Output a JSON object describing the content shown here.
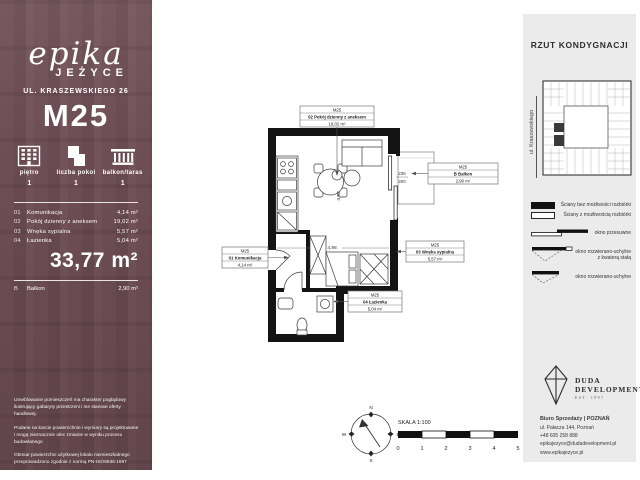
{
  "colors": {
    "maroon": "#6f4f56",
    "panel_gray": "#ebebeb",
    "wall_black": "#141414"
  },
  "left": {
    "logo_script": "epika",
    "logo_sub": "JEŻYCE",
    "address": "UL. KRASZEWSKIEGO 26",
    "unit": "M25",
    "stats": [
      {
        "icon": "building-floor-icon",
        "label": "piętro",
        "value": "1"
      },
      {
        "icon": "rooms-icon",
        "label": "liczba pokoi",
        "value": "1"
      },
      {
        "icon": "balcony-icon",
        "label": "balkon/taras",
        "value": "1"
      }
    ],
    "rooms": [
      {
        "no": "01",
        "name": "Komunikacja",
        "area": "4,14 m²"
      },
      {
        "no": "02",
        "name": "Pokój dzienny z aneksem",
        "area": "19,02 m²"
      },
      {
        "no": "03",
        "name": "Wnęka sypialna",
        "area": "5,57 m²"
      },
      {
        "no": "04",
        "name": "Łazienka",
        "area": "5,04 m²"
      }
    ],
    "total_area": "33,77 m²",
    "balcony_row": {
      "no": "B",
      "name": "Balkon",
      "area": "2,90 m²"
    },
    "disclaimers": [
      "Umeblowanie pomieszczeń ma charakter poglądowy ilustrujący gabaryty przestrzeni i nie stanowi oferty handlowej.",
      "Podane na karcie powierzchnie i wymiary są projektowane i mogą nieznacznie ulec zmianie w wyniku procesu budowlanego",
      "Obmiar powierzchni użytkowej lokalu niemieszkalnego przeprowadzono zgodnie z normą PN-ISO9836:1997"
    ]
  },
  "plan": {
    "labels": [
      {
        "unit": "M25",
        "room": "02 Pokój dzienny z aneksem",
        "area": "19,02 m²"
      },
      {
        "unit": "M25",
        "room": "B Balkon",
        "area": "2,90 m²"
      },
      {
        "unit": "M25",
        "room": "01 Komunikacja",
        "area": "4,14 m²"
      },
      {
        "unit": "M25",
        "room": "03 Wnęka sypialna",
        "area": "5,57 m²"
      },
      {
        "unit": "M25",
        "room": "04 Łazienka",
        "area": "5,04 m²"
      }
    ],
    "dims": {
      "living_width": "4,98",
      "living_depth": "3,92",
      "window_width": "235",
      "window_height": "200"
    },
    "scale": {
      "label": "SKALA 1:100",
      "ticks": [
        "0",
        "1",
        "2",
        "3",
        "4",
        "5"
      ]
    },
    "compass": {
      "n": "N",
      "e": "E",
      "s": "S",
      "w": "W"
    }
  },
  "right": {
    "title": "RZUT KONDYGNACJI",
    "street": "ul. Kraszewskiego",
    "legend": [
      {
        "label": "Ściany bez możliwości rozbiórki"
      },
      {
        "label": "Ściany z możliwością rozbiórki"
      },
      {
        "label": "okno przesuwne"
      },
      {
        "label": "okno rozwierano-uchylne",
        "label2": "z kwaterą stałą"
      },
      {
        "label": "okno rozwierano-uchylne"
      }
    ],
    "logo": {
      "line1": "DUDA",
      "line2": "DEVELOPMENT",
      "est": "EST. 1997"
    },
    "contact": {
      "office": "Biuro Sprzedaży | POZNAŃ",
      "address": "ul. Pałacza 144, Poznań",
      "phone": "+48 605 258 888",
      "email": "epikajezyce@dudadevelopment.pl",
      "www": "www.epikajezyce.pl"
    }
  }
}
